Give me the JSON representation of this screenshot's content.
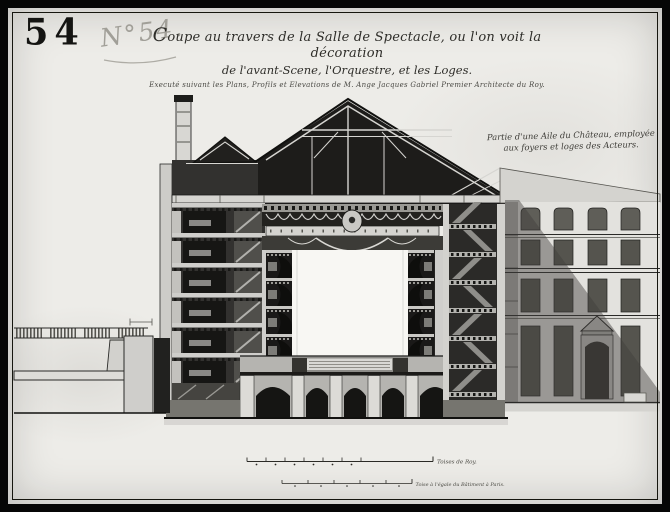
{
  "colors": {
    "frame": "#060606",
    "paper": "#edece8",
    "ink": "#1b1b19",
    "light_wash": "#d6d5d1",
    "shadow_wash": "#55544f"
  },
  "stamp": {
    "stencil_number": "54",
    "hand_number": "N°54."
  },
  "title": {
    "line1": "Coupe au travers de la Salle de Spectacle, ou l'on voit la décoration",
    "line2": "de l'avant-Scene, l'Orquestre, et les Loges.",
    "line3": "Executé suivant les Plans, Profils et Elevations de M. Ange Jacques Gabriel Premier Architecte du Roy."
  },
  "wing_note": {
    "line1": "Partie d'une Aile du Château, employée",
    "line2": "aux foyers et loges des Acteurs."
  },
  "scale_bars": {
    "toises_label": "Toises de Roy.",
    "paris_label": "Toise à l'égale du Bâtiment à Paris."
  }
}
